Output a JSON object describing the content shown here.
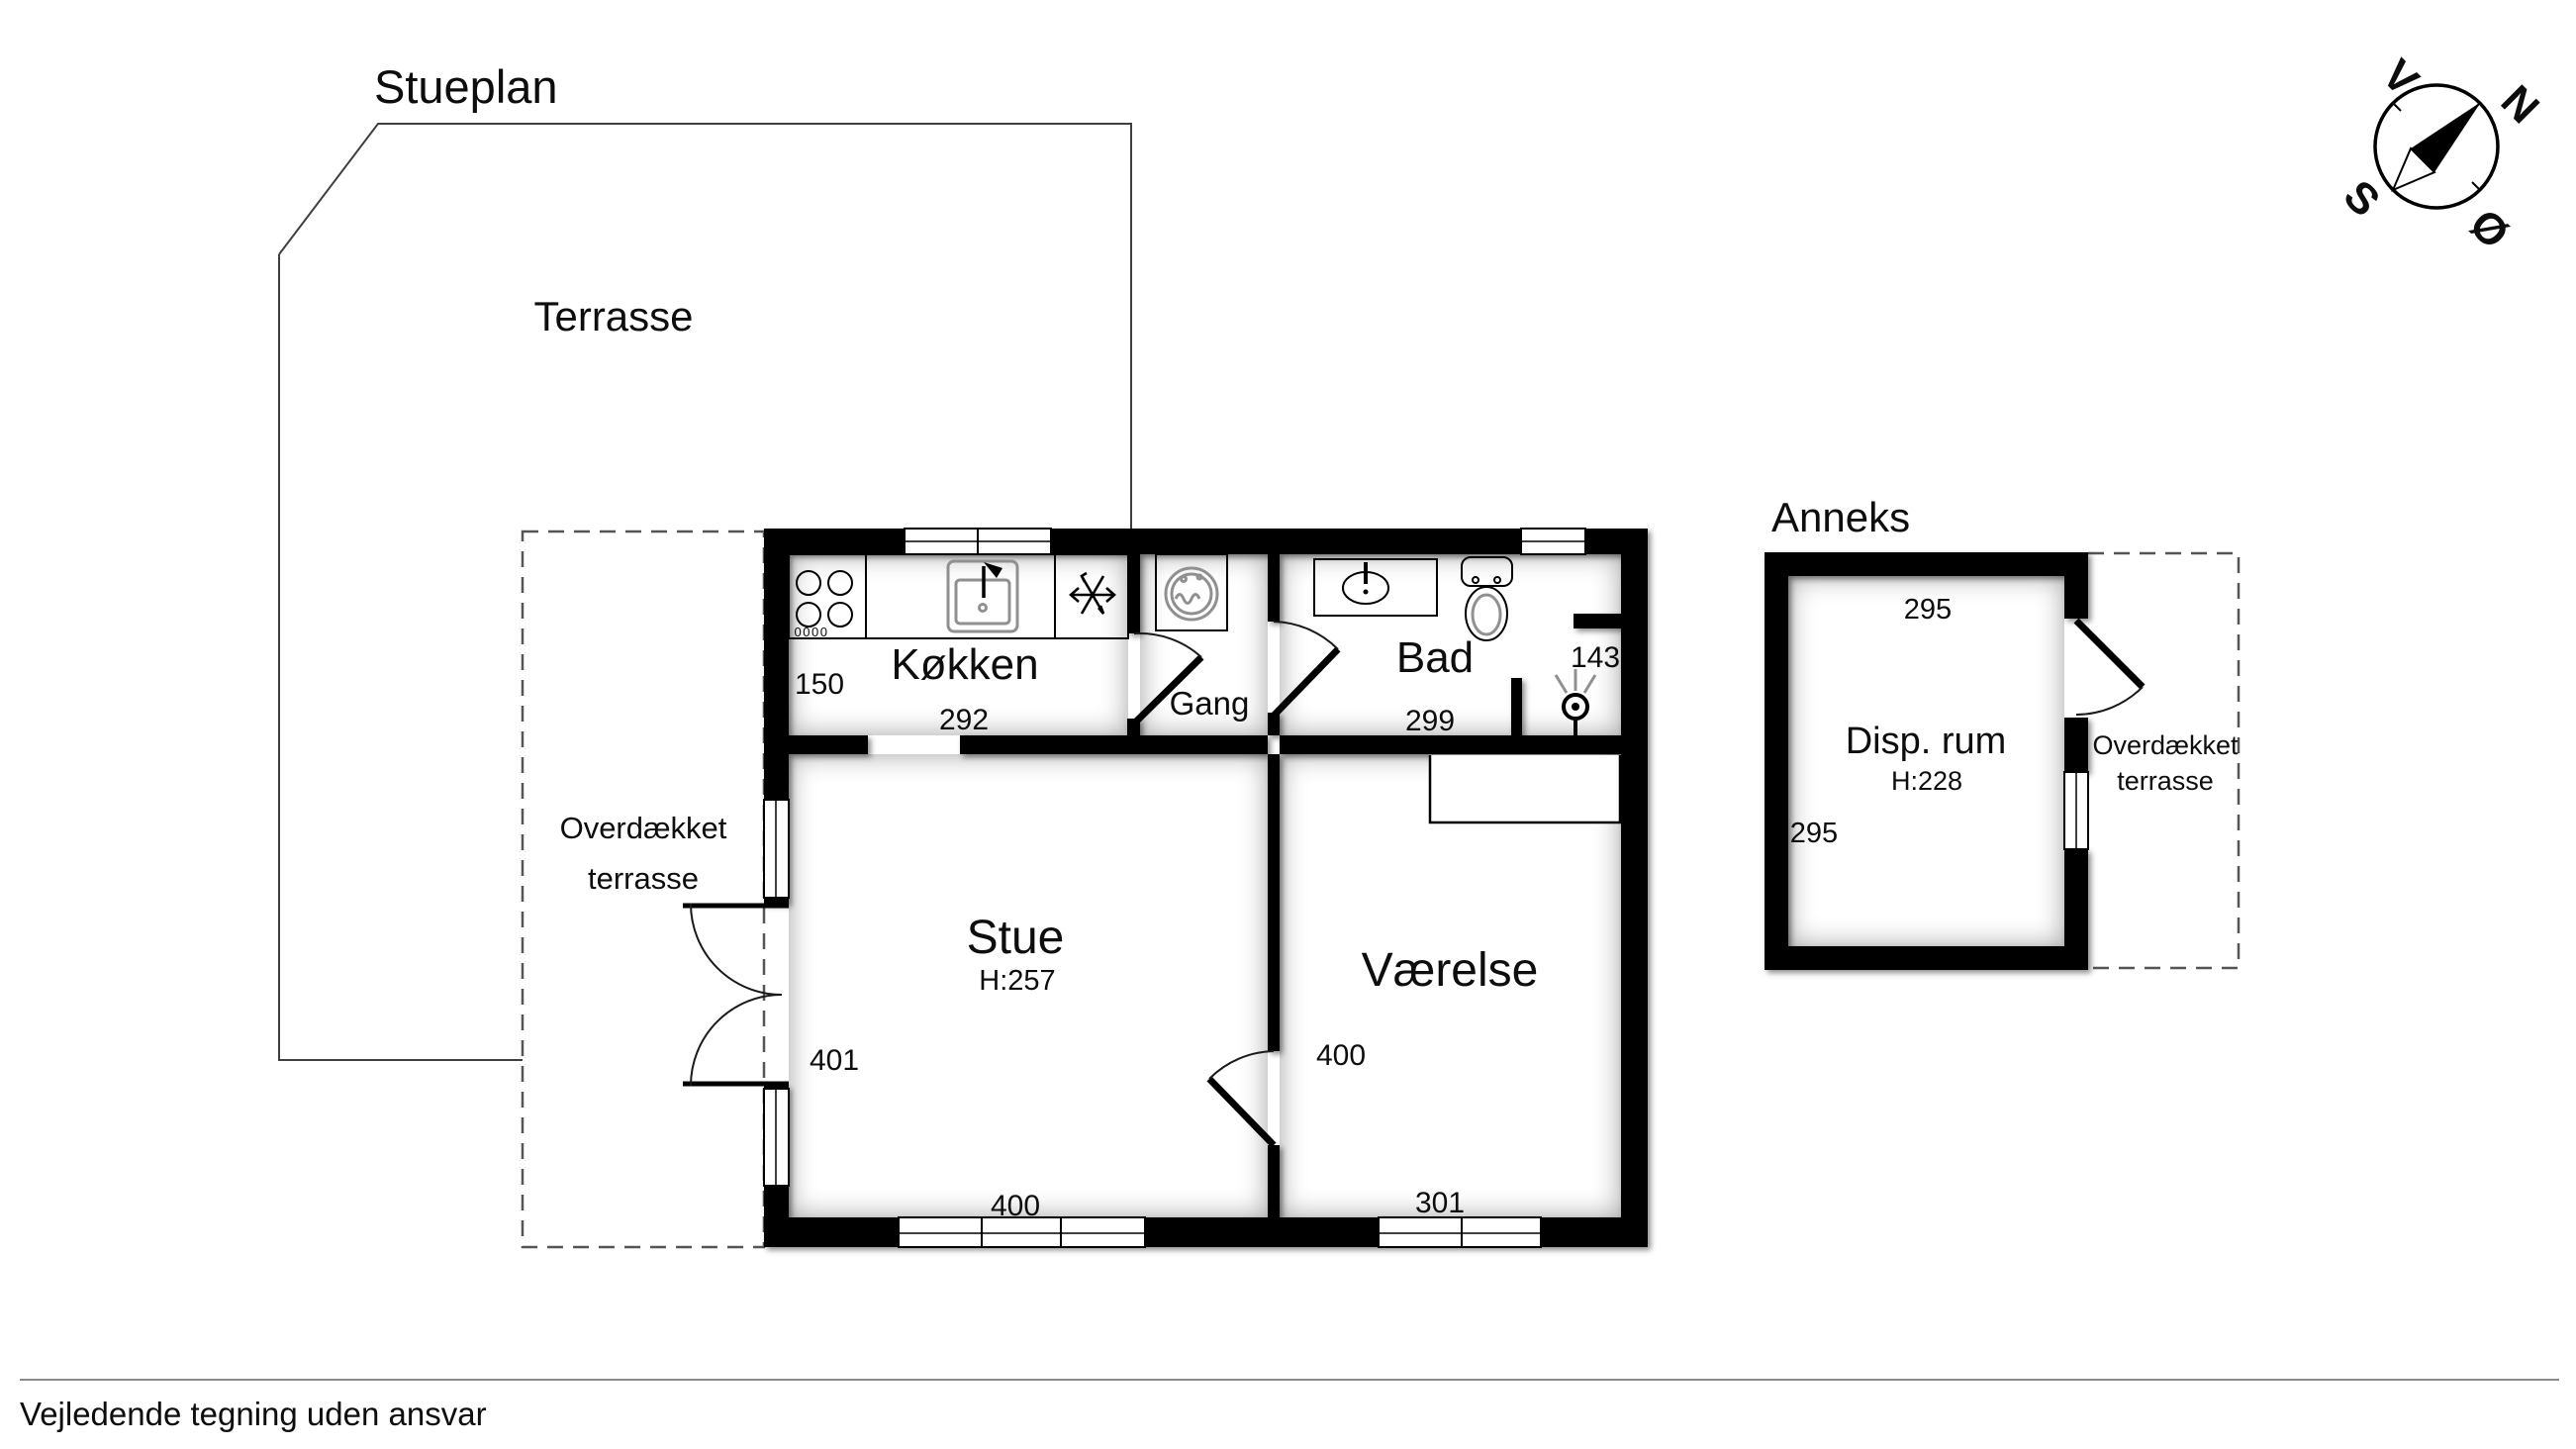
{
  "page": {
    "title": "Stueplan",
    "footer": "Vejledende tegning uden ansvar"
  },
  "terrace": {
    "label": "Terrasse"
  },
  "covered_terrace": {
    "line1": "Overdækket",
    "line2": "terrasse"
  },
  "rooms": {
    "kitchen": {
      "name": "Køkken",
      "dim_side": "150",
      "dim_width": "292",
      "knobs": "0000"
    },
    "hall": {
      "name": "Gang"
    },
    "bath": {
      "name": "Bad",
      "dim_width": "299",
      "dim_shower": "143"
    },
    "living": {
      "name": "Stue",
      "ceiling": "H:257",
      "dim_side": "401",
      "dim_width": "400"
    },
    "bedroom": {
      "name": "Værelse",
      "dim_width": "301",
      "dim_door": "400"
    }
  },
  "annex": {
    "title": "Anneks",
    "room": {
      "name": "Disp. rum",
      "ceiling": "H:228",
      "dim_top": "295",
      "dim_side": "295"
    },
    "covered_terrace": {
      "line1": "Overdækket",
      "line2": "terrasse"
    }
  },
  "compass": {
    "v": "V",
    "n": "N",
    "s": "S",
    "o": "Ø"
  },
  "colors": {
    "wall": "#000000",
    "line": "#3f3f3f",
    "text": "#0d0d0d"
  }
}
